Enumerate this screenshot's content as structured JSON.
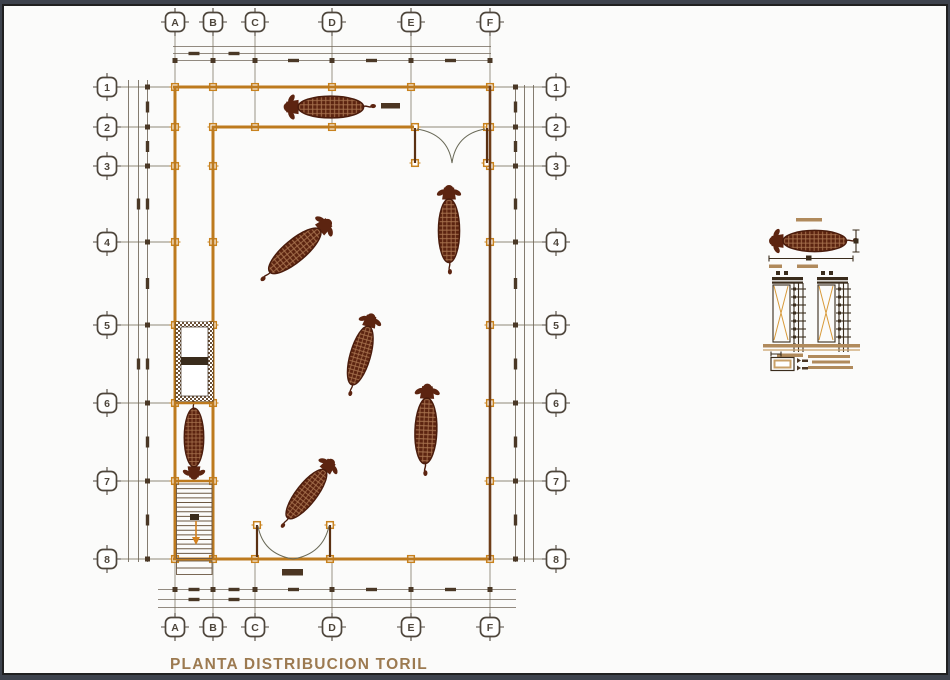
{
  "page": {
    "title_label": "PLANTA DISTRIBUCION TORIL"
  },
  "colors": {
    "background": "#3e434d",
    "paper": "#fbfbfa",
    "wall_orange": "#bd7a1e",
    "wall_dark_brown": "#6e3d18",
    "bull_brown": "#5c2410",
    "grid_gray": "#8f8878",
    "tick_brown": "#4a3826",
    "tan_accent": "#b08a5c",
    "title_tan": "#9c7a50",
    "marker_orange": "#c8821e"
  },
  "axes": {
    "cols": [
      {
        "label": "A",
        "x": 175
      },
      {
        "label": "B",
        "x": 213
      },
      {
        "label": "C",
        "x": 255
      },
      {
        "label": "D",
        "x": 332
      },
      {
        "label": "E",
        "x": 411
      },
      {
        "label": "F",
        "x": 490
      }
    ],
    "rows": [
      {
        "label": "1",
        "y": 87
      },
      {
        "label": "2",
        "y": 127
      },
      {
        "label": "3",
        "y": 166
      },
      {
        "label": "4",
        "y": 242
      },
      {
        "label": "5",
        "y": 325
      },
      {
        "label": "6",
        "y": 403
      },
      {
        "label": "7",
        "y": 481
      },
      {
        "label": "8",
        "y": 559
      }
    ],
    "top_bubble_y": 22,
    "bottom_bubble_y": 627,
    "left_bubble_x": 107,
    "right_bubble_x": 556
  },
  "bulls": [
    {
      "cx": 328,
      "cy": 107,
      "rot": -90,
      "s": 0.95
    },
    {
      "cx": 297,
      "cy": 249,
      "rot": 50,
      "s": 0.95
    },
    {
      "cx": 449,
      "cy": 228,
      "rot": 0,
      "s": 0.92
    },
    {
      "cx": 361,
      "cy": 353,
      "rot": 16,
      "s": 0.88
    },
    {
      "cx": 426,
      "cy": 428,
      "rot": 2,
      "s": 0.95
    },
    {
      "cx": 308,
      "cy": 492,
      "rot": 38,
      "s": 0.88
    },
    {
      "cx": 194,
      "cy": 440,
      "rot": 180,
      "s": 0.85
    },
    {
      "cx": 812,
      "cy": 241,
      "rot": -90,
      "s": 0.92
    }
  ],
  "markers": [
    [
      175,
      87
    ],
    [
      213,
      87
    ],
    [
      255,
      87
    ],
    [
      332,
      87
    ],
    [
      411,
      87
    ],
    [
      490,
      87
    ],
    [
      175,
      127
    ],
    [
      213,
      127
    ],
    [
      255,
      127
    ],
    [
      332,
      127
    ],
    [
      415,
      127
    ],
    [
      487,
      127
    ],
    [
      490,
      127
    ],
    [
      175,
      559
    ],
    [
      213,
      559
    ],
    [
      255,
      559
    ],
    [
      330,
      559
    ],
    [
      411,
      559
    ],
    [
      490,
      559
    ],
    [
      175,
      166
    ],
    [
      175,
      242
    ],
    [
      175,
      325
    ],
    [
      175,
      403
    ],
    [
      175,
      481
    ],
    [
      213,
      166
    ],
    [
      213,
      242
    ],
    [
      213,
      325
    ],
    [
      213,
      403
    ],
    [
      213,
      481
    ],
    [
      490,
      166
    ],
    [
      490,
      242
    ],
    [
      490,
      325
    ],
    [
      490,
      403
    ],
    [
      490,
      481
    ],
    [
      415,
      163
    ],
    [
      487,
      163
    ],
    [
      257,
      525
    ],
    [
      330,
      525
    ]
  ],
  "stairs": {
    "x": 176.5,
    "w": 35.5,
    "y0": 484,
    "y1": 558,
    "treads": 15
  }
}
